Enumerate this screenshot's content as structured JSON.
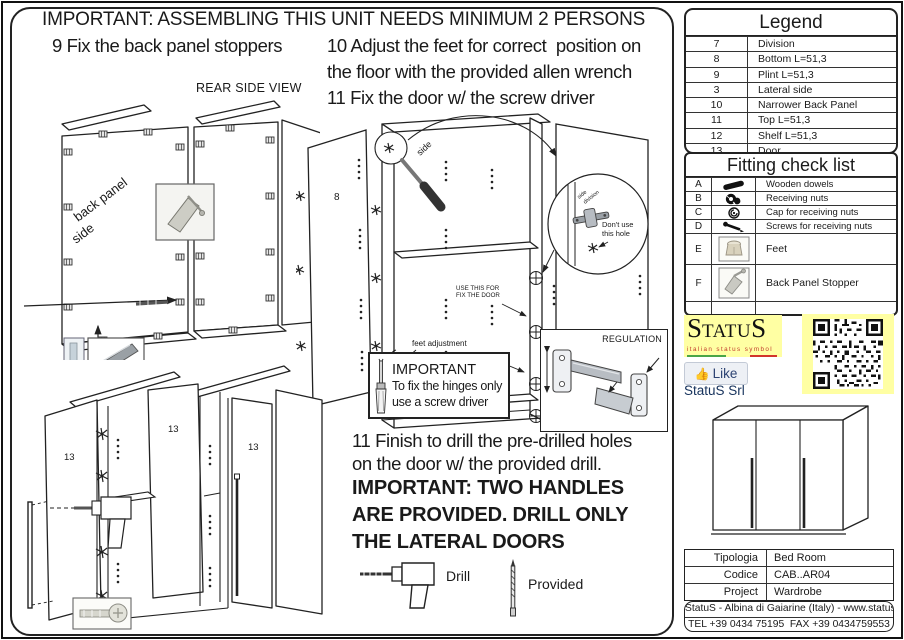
{
  "page": {
    "title": "IMPORTANT: ASSEMBLING THIS UNIT NEEDS MINIMUM 2 PERSONS"
  },
  "steps": {
    "step9": "9 Fix the back panel stoppers",
    "step10_l1": "10 Adjust the feet for correct  position on",
    "step10_l2": "the floor with the provided allen wrench",
    "step11": "11 Fix the door w/ the screw driver",
    "finish_l1": "11 Finish to drill the pre-drilled holes",
    "finish_l2": "on the door w/ the provided drill.",
    "finish_b1": "IMPORTANT: TWO HANDLES",
    "finish_b2": "ARE PROVIDED. DRILL ONLY",
    "finish_b3": "THE LATERAL DOORS"
  },
  "diagram_labels": {
    "rear_side_view": "REAR SIDE VIEW",
    "back_panel": "back panel",
    "back_panel_side2": "side",
    "screwdriver_side": "side",
    "inset_side": "side",
    "inset_division": "division",
    "dont_use_l1": "Don't use",
    "dont_use_l2": "this hole",
    "use_this_l1": "USE THIS FOR",
    "use_this_l2": "FIX THE DOOR",
    "feet_adjustment": "feet adjustment",
    "regulation": "REGULATION",
    "panel_8": "8",
    "door_13": "13",
    "important_title": "IMPORTANT",
    "important_l1": "To fix the hinges only",
    "important_l2": "use a screw driver",
    "drill": "Drill",
    "provided": "Provided"
  },
  "legend": {
    "title": "Legend",
    "rows": [
      {
        "num": "7",
        "desc": "Division"
      },
      {
        "num": "8",
        "desc": "Bottom L=51,3"
      },
      {
        "num": "9",
        "desc": "Plint L=51,3"
      },
      {
        "num": "3",
        "desc": "Lateral side"
      },
      {
        "num": "10",
        "desc": "Narrower Back Panel"
      },
      {
        "num": "11",
        "desc": "Top L=51,3"
      },
      {
        "num": "12",
        "desc": "Shelf L=51,3"
      },
      {
        "num": "13",
        "desc": "Door"
      }
    ]
  },
  "fitting": {
    "title": "Fitting check list",
    "rows": [
      {
        "letter": "A",
        "icon": "wooden-dowel-icon",
        "desc": "Wooden dowels"
      },
      {
        "letter": "B",
        "icon": "receiving-nut-icon",
        "desc": "Receiving nuts"
      },
      {
        "letter": "C",
        "icon": "cap-icon",
        "desc": "Cap for receiving nuts"
      },
      {
        "letter": "D",
        "icon": "screw-icon",
        "desc": "Screws for receiving nuts"
      },
      {
        "letter": "E",
        "icon": "feet-photo-icon",
        "desc": "Feet"
      },
      {
        "letter": "F",
        "icon": "back-panel-stopper-photo-icon",
        "desc": "Back Panel Stopper"
      }
    ]
  },
  "brand": {
    "logo_first": "S",
    "logo_mid": "TATU",
    "logo_last": "S",
    "tagline": "italian status symbol",
    "like_label": "Like",
    "like_thumb": "👍",
    "company": "StatuS Srl",
    "colors": {
      "logo_bg": "#ffffa3",
      "tagline_red": "#c0392b",
      "flag_green": "#4aa546",
      "flag_red": "#d2342a",
      "like_blue": "#3b5998"
    }
  },
  "info_table": {
    "rows": [
      {
        "label": "Tipologia",
        "value": "Bed Room"
      },
      {
        "label": "Codice",
        "value": "CAB..AR04"
      },
      {
        "label": "Project",
        "value": "Wardrobe"
      }
    ]
  },
  "footer": {
    "line1": "StatuS - Albina di Gaiarine (Italy) - www.statusitaly.it",
    "line2": "TEL +39 0434 75195  FAX +39 0434759553"
  }
}
